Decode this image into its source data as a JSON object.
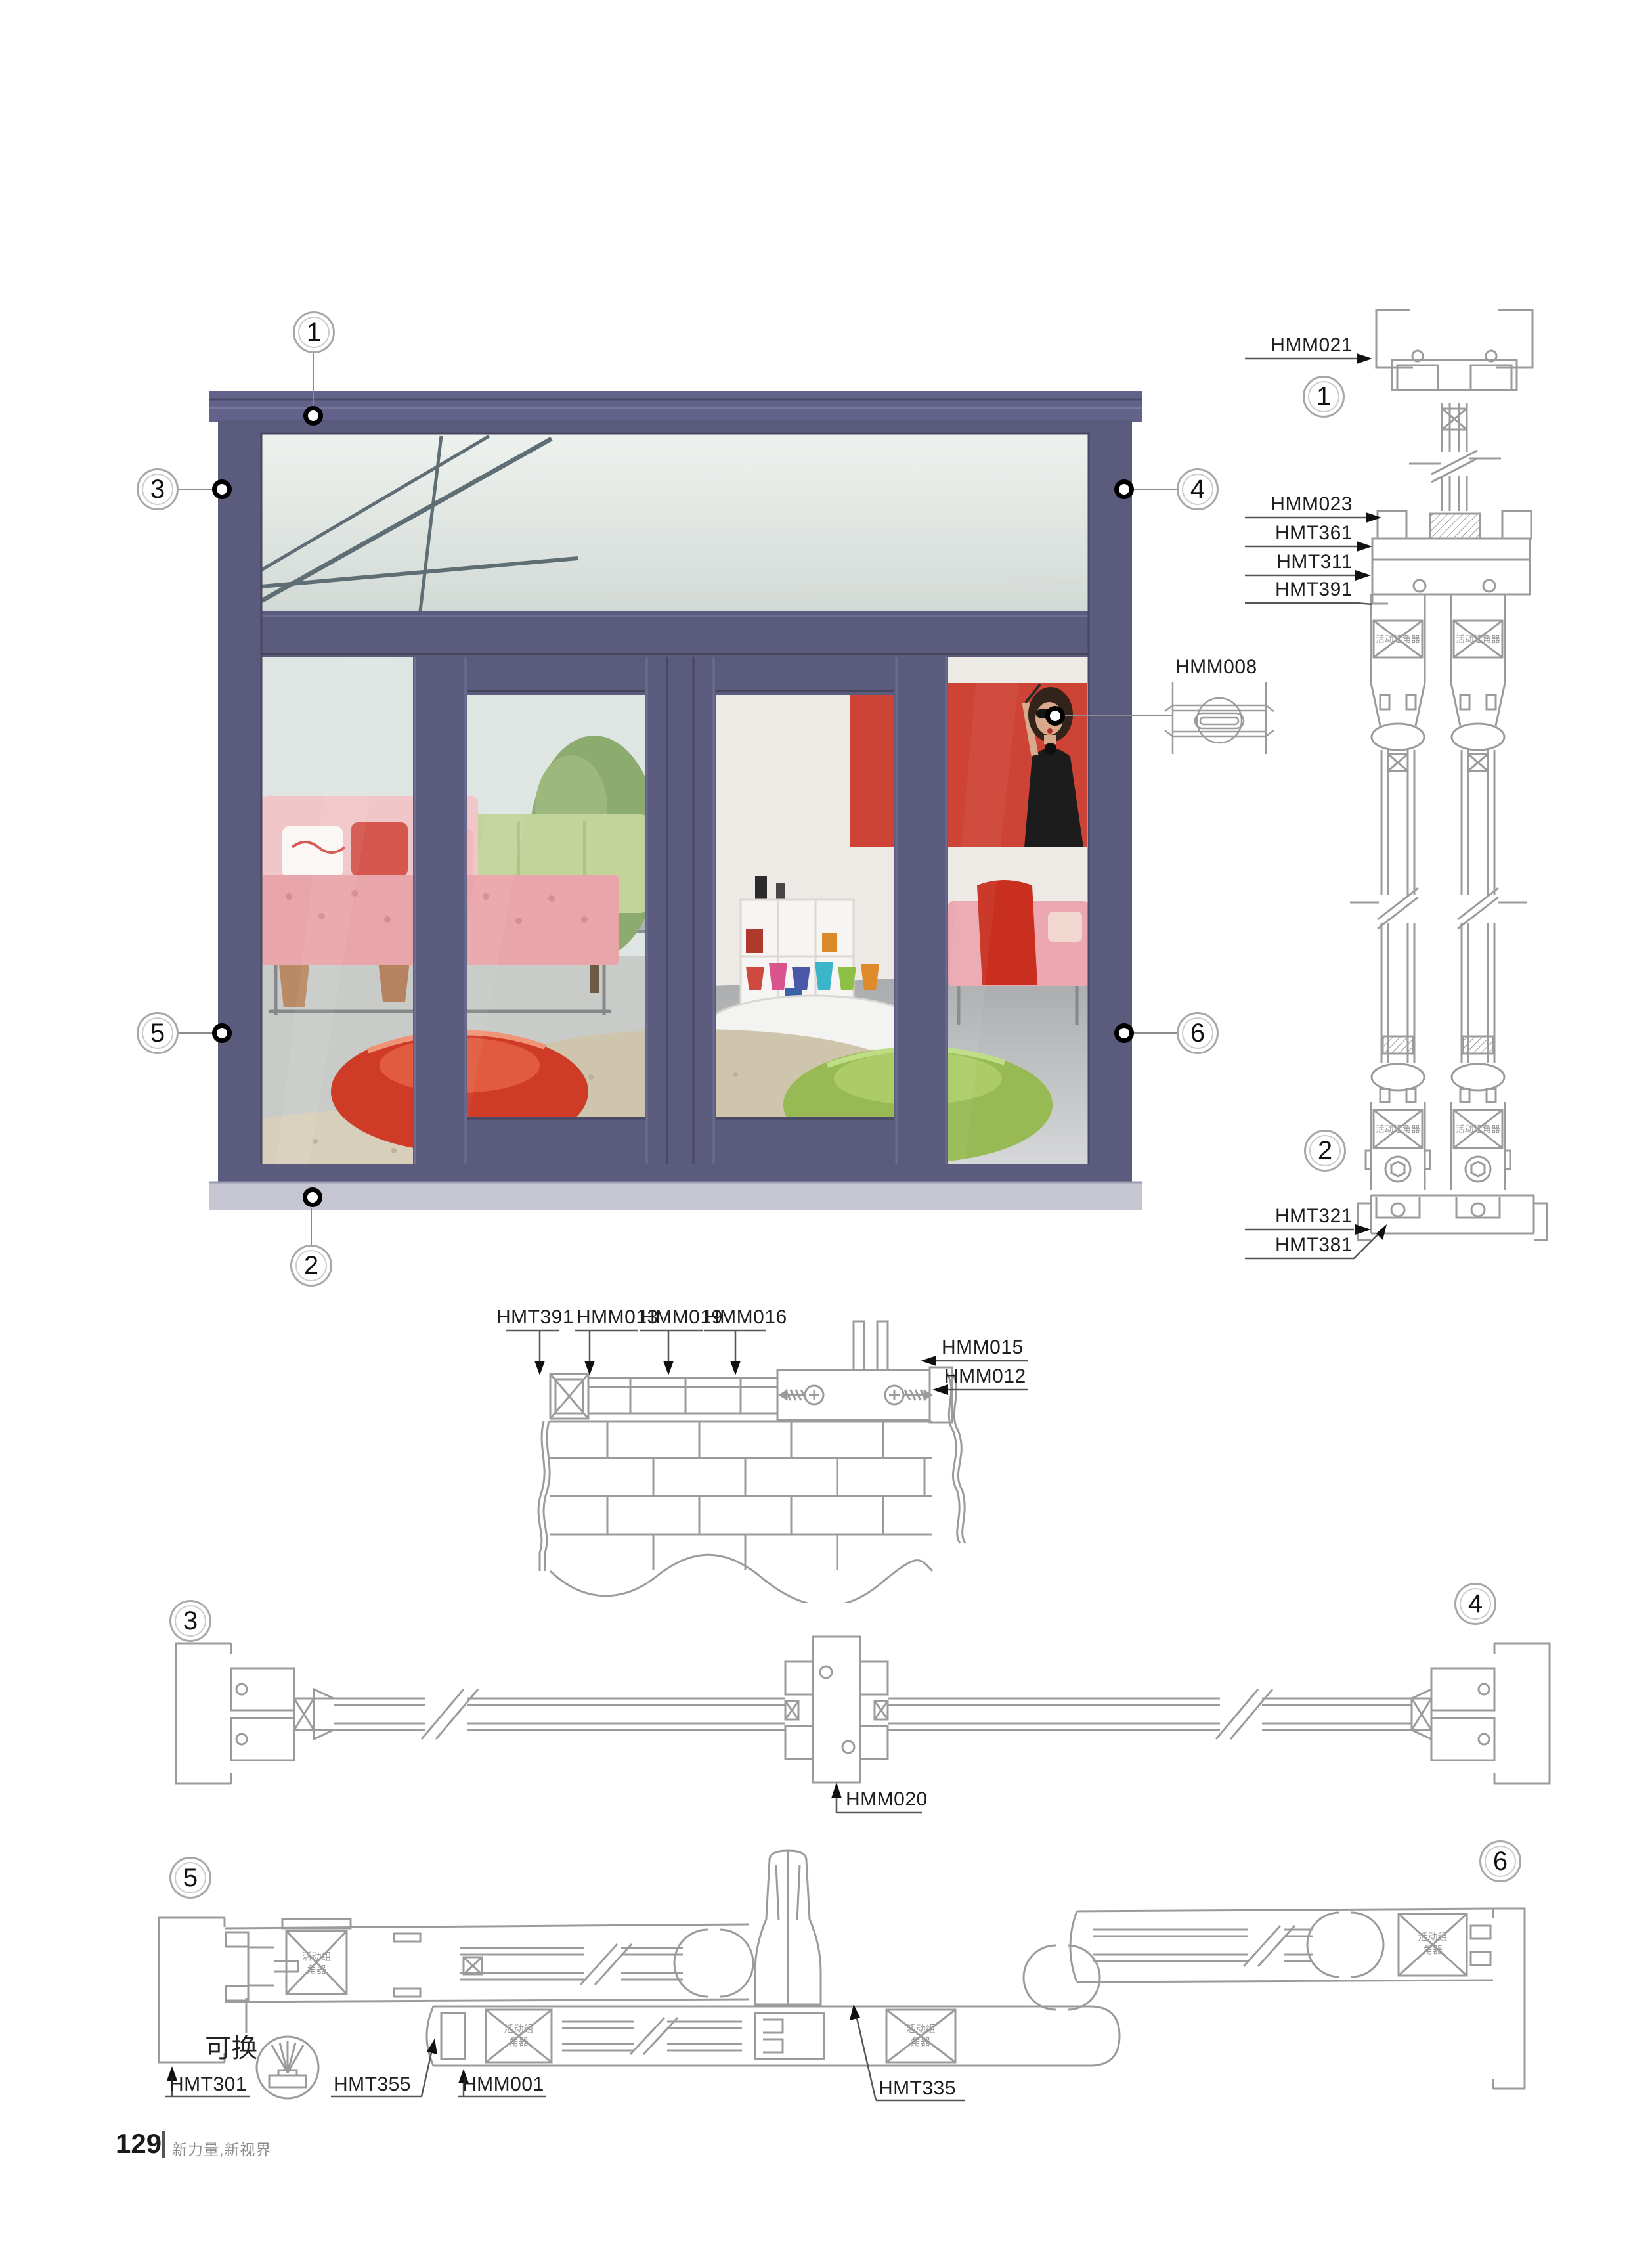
{
  "page": {
    "footer": {
      "page_number": "129",
      "slogan": "新力量,新视界"
    }
  },
  "colors": {
    "frame-purple": "#5b5b7d",
    "frame-purple-light": "#6e6e92",
    "frame-purple-dark": "#45455e",
    "sill-gray": "#c6c6d2",
    "drawing-line": "#9b9b9b",
    "label-ink": "#1f1f1f",
    "painting-red": "#cd4335",
    "pouf-red": "#ce3b27",
    "pouf-green": "#97ba54"
  },
  "markers": {
    "m1": "1",
    "m2": "2",
    "m3": "3",
    "m4": "4",
    "m5": "5",
    "m6": "6"
  },
  "shared": {
    "corner_connector": "活动组角器",
    "corner_connector_line1": "活动组",
    "corner_connector_line2": "角器"
  },
  "elevation": {
    "callout_label": "HMM008"
  },
  "vertical_section": {
    "hmm021": "HMM021",
    "hmm023": "HMM023",
    "hmt361": "HMT361",
    "hmt311": "HMT311",
    "hmt391": "HMT391",
    "hmt321": "HMT321",
    "hmt381": "HMT381"
  },
  "wall_detail": {
    "hmt391": "HMT391",
    "hmm013": "HMM013",
    "hmm019": "HMM019",
    "hmm016": "HMM016",
    "hmm015": "HMM015",
    "hmm012": "HMM012"
  },
  "plan_mid": {
    "hmm020": "HMM020"
  },
  "plan_bottom": {
    "replaceable": "可换",
    "hmt301": "HMT301",
    "hmt355": "HMT355",
    "hmm001": "HMM001",
    "hmt335": "HMT335"
  }
}
